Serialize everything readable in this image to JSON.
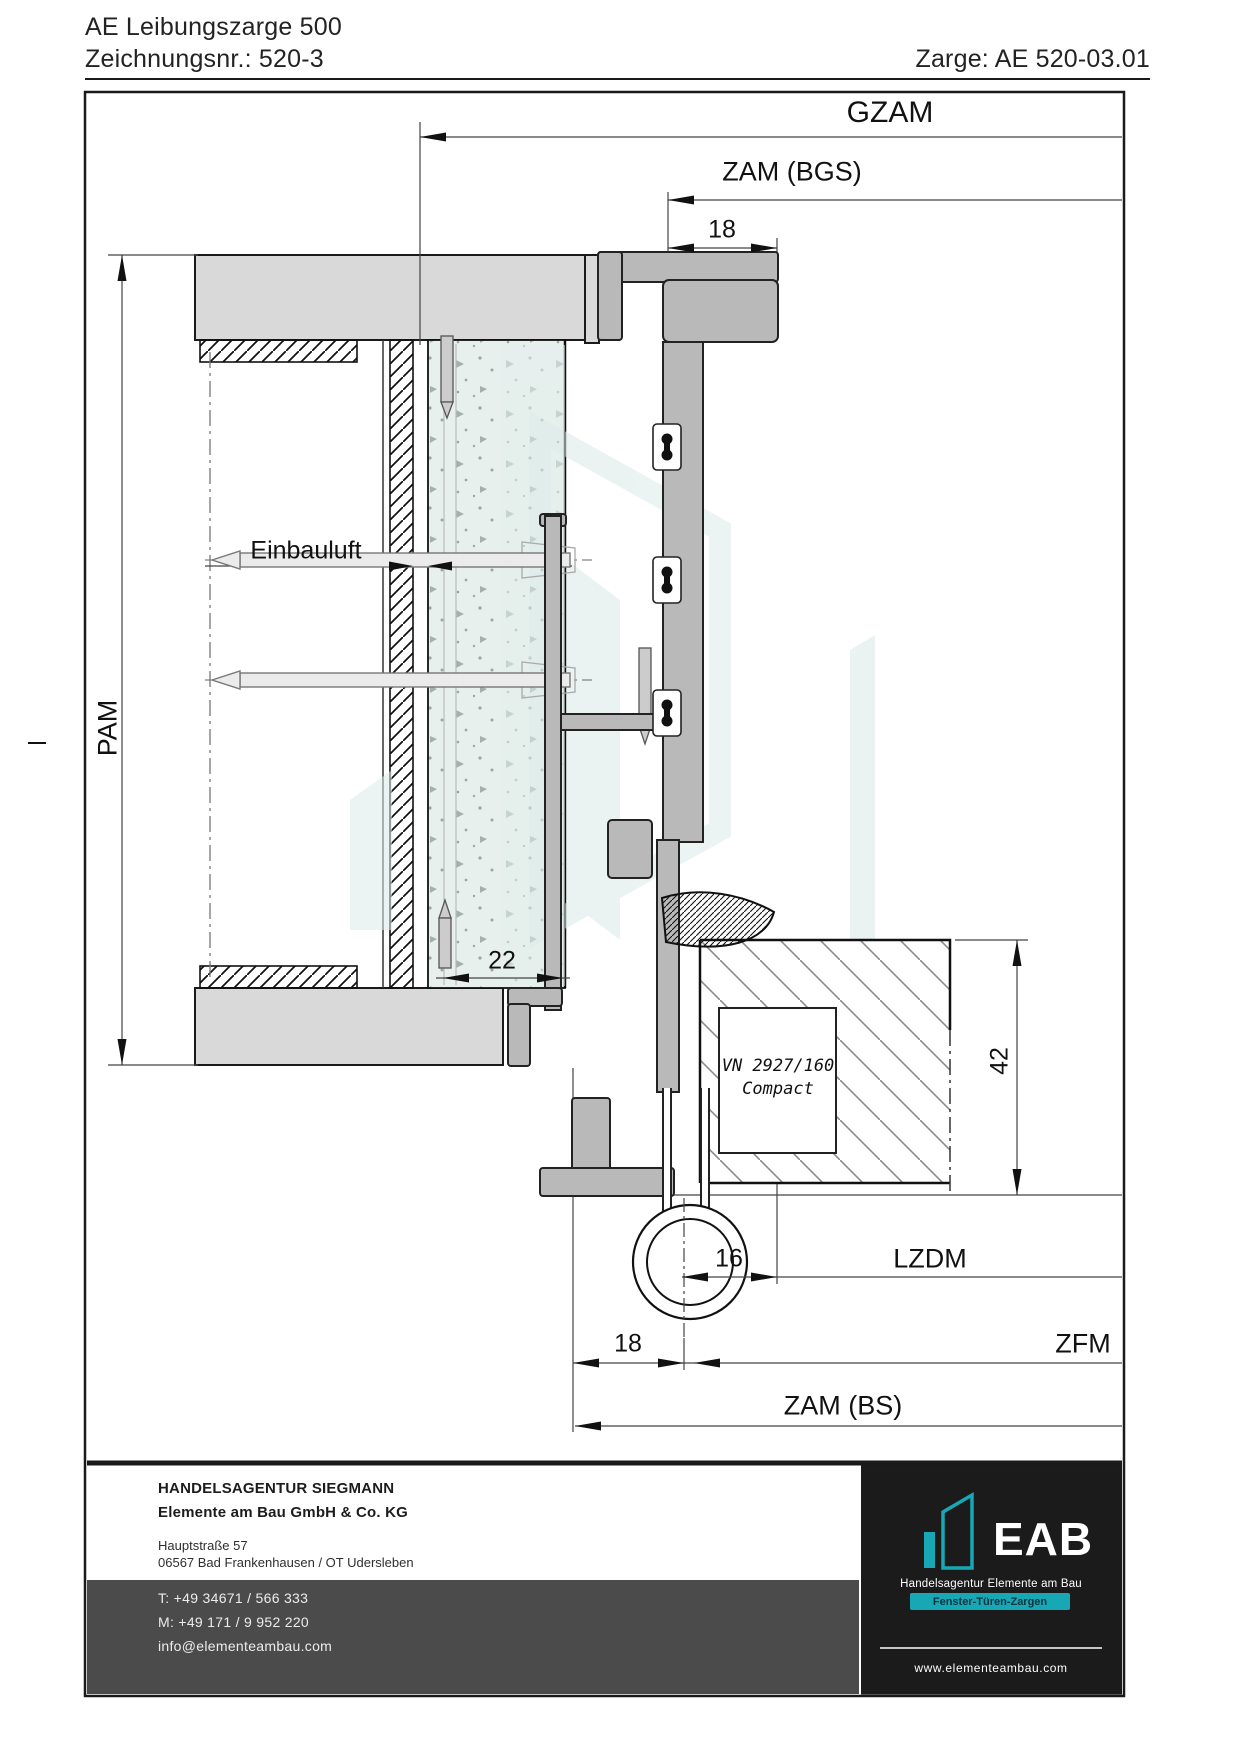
{
  "header": {
    "title_line1": "AE Leibungszarge 500",
    "title_line2": "Zeichnungsnr.: 520-3",
    "zarge_ref": "Zarge: AE 520-03.01"
  },
  "dimensions": {
    "gzam": "GZAM",
    "zam_bgs": "ZAM (BGS)",
    "top_18": "18",
    "pam": "PAM",
    "einbauluft": "Einbauluft",
    "wall_22": "22",
    "leaf_42": "42",
    "hinge_16": "16",
    "lzdm": "LZDM",
    "bottom_18": "18",
    "zfm": "ZFM",
    "zam_bs": "ZAM (BS)"
  },
  "annotations": {
    "hinge_line1": "VN 2927/160",
    "hinge_line2": "Compact"
  },
  "footer": {
    "company_line1": "HANDELSAGENTUR SIEGMANN",
    "company_line2": "Elemente am Bau GmbH & Co. KG",
    "address_line1": "Hauptstraße 57",
    "address_line2": "06567 Bad Frankenhausen / OT Udersleben",
    "phone_t": "T: +49 34671 / 566 333",
    "phone_m": "M: +49 171 / 9 952 220",
    "email": "info@elementeambau.com",
    "logo": {
      "acronym": "EAB",
      "subtitle": "Handelsagentur Elemente am Bau",
      "tagline": "Fenster-Türen-Zargen",
      "website": "www.elementeambau.com"
    }
  },
  "colors": {
    "teal": "#18a7b5",
    "aluminum": "#b9b9b9",
    "concrete": "#d9d9d9",
    "footer_gray": "#4b4b4b",
    "footer_black": "#1b1b1b",
    "speckle_bg": "#e8f0ee"
  }
}
